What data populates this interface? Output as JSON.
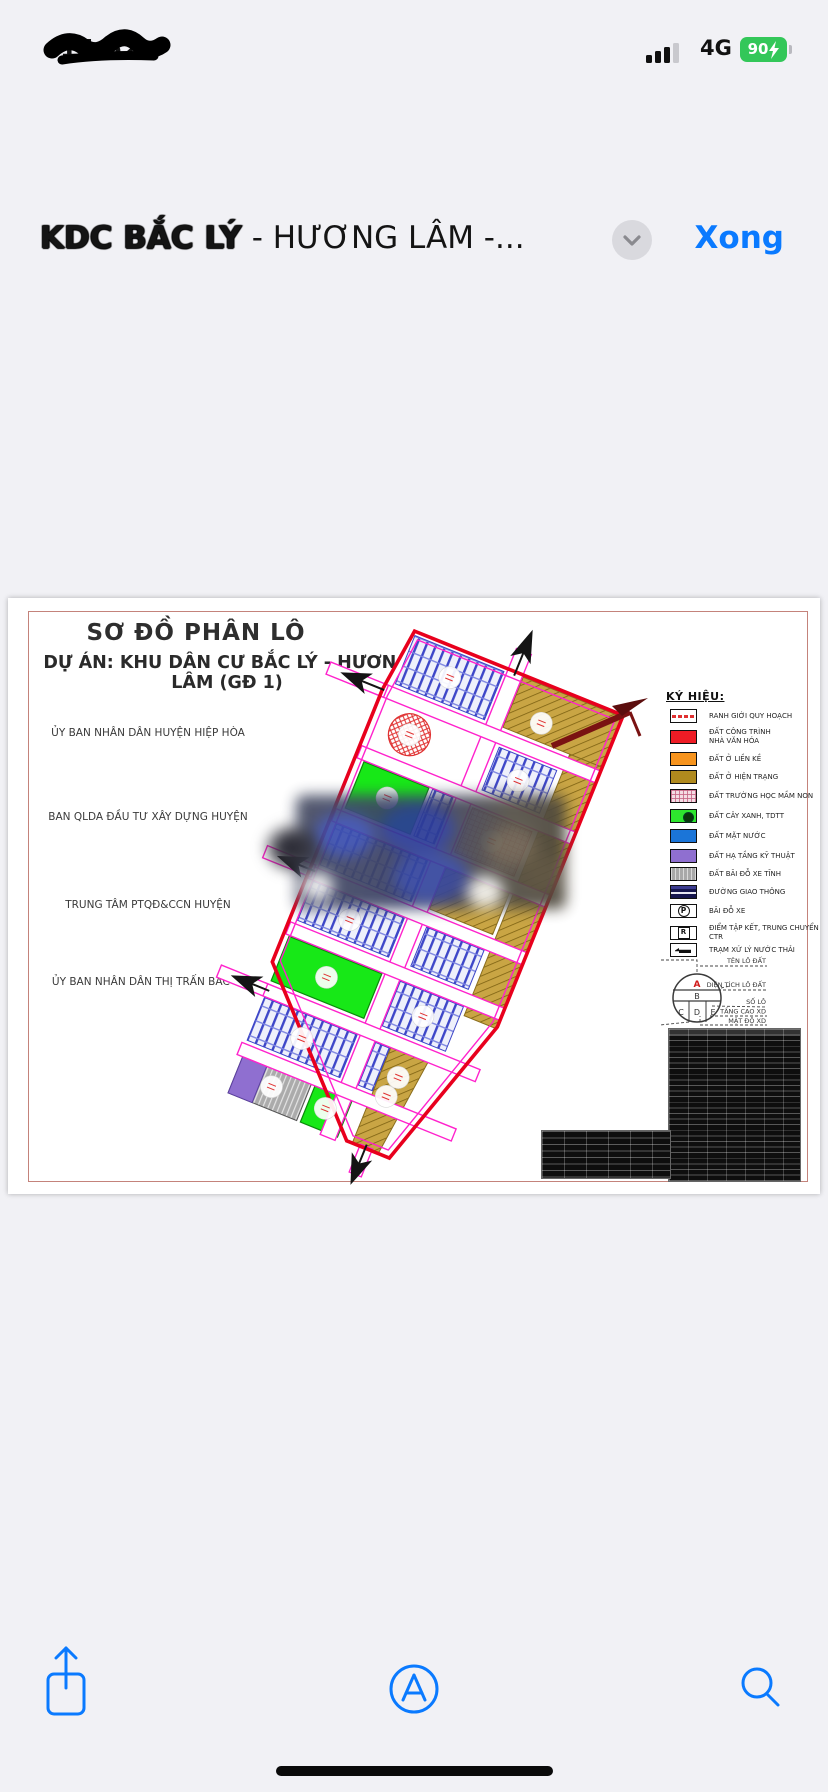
{
  "status_bar": {
    "time": "14:52",
    "network": "4G",
    "battery_percent": "90",
    "battery_color": "#33c759",
    "charging": true
  },
  "title_bar": {
    "title_bold": "KDC BẮC LÝ",
    "title_rest": " - HƯƠNG LÂM -...",
    "done_label": "Xong",
    "accent_color": "#0a7aff"
  },
  "document": {
    "title": "SƠ ĐỒ PHÂN LÔ",
    "subtitle": "DỰ ÁN: KHU DÂN CƯ BẮC LÝ - HƯƠNG LÂM (GĐ 1)",
    "organizations": [
      "ỦY BAN NHÂN DÂN HUYỆN HIỆP HÒA",
      "BAN QLDA ĐẦU TƯ XÂY DỰNG HUYỆN",
      "TRUNG TÂM PTQĐ&CCN HUYỆN",
      "ỦY BAN NHÂN DÂN THỊ TRẤN BẮC LÝ"
    ],
    "legend": {
      "heading": "KÝ HIỆU:",
      "items": [
        {
          "label": "RANH GIỚI QUY HOẠCH",
          "swatch": "boundary",
          "color": "#ffffff"
        },
        {
          "label": "ĐẤT CÔNG TRÌNH\nNHÀ VĂN HÓA",
          "swatch": "solid",
          "color": "#ee1c25"
        },
        {
          "label": "ĐẤT Ở LIỀN KỀ",
          "swatch": "solid",
          "color": "#f7941d"
        },
        {
          "label": "ĐẤT Ở HIỆN TRẠNG",
          "swatch": "solid",
          "color": "#b08a1e"
        },
        {
          "label": "ĐẤT TRƯỜNG HỌC MẦM NON",
          "swatch": "checker",
          "color": "#f4dce4"
        },
        {
          "label": "ĐẤT CÂY XANH, TDTT",
          "swatch": "green",
          "color": "#2ee62e"
        },
        {
          "label": "ĐẤT MẶT NƯỚC",
          "swatch": "solid",
          "color": "#1b75d8"
        },
        {
          "label": "ĐẤT HẠ TẦNG KỸ THUẬT",
          "swatch": "solid",
          "color": "#8f6fd0"
        },
        {
          "label": "ĐẤT BÃI ĐỖ XE TĨNH",
          "swatch": "stripes",
          "color": "#a8a8a8"
        },
        {
          "label": "ĐƯỜNG GIAO THÔNG",
          "swatch": "road",
          "color": "#1c1c62"
        },
        {
          "label": "BÃI ĐỖ XE",
          "swatch": "glyph-circled",
          "glyph": "P"
        },
        {
          "label": "ĐIỂM TẬP KẾT, TRUNG CHUYỂN CTR",
          "swatch": "glyph-boxed",
          "glyph": "R"
        },
        {
          "label": "TRẠM XỬ LÝ NƯỚC THẢI",
          "swatch": "pump"
        }
      ]
    },
    "lot_symbol": {
      "cells": {
        "a": "A",
        "b": "B",
        "c": "C",
        "d": "D",
        "e": "E"
      },
      "callouts": [
        "TÊN LÔ ĐẤT",
        "DIỆN TÍCH LÔ ĐẤT",
        "SỐ LÔ",
        "TẦNG CAO XD",
        "MẬT ĐỘ XD"
      ]
    }
  },
  "toolbar": {
    "icons": [
      "share-icon",
      "markup-icon",
      "search-icon"
    ]
  },
  "colors": {
    "accent": "#0a7aff",
    "plan_boundary": "#e8001d",
    "plan_road": "#ff22cc"
  }
}
